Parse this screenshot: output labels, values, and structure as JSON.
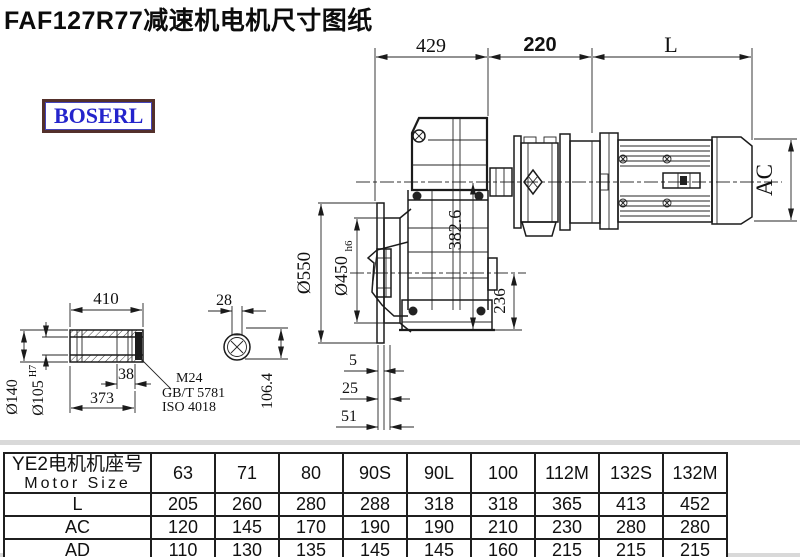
{
  "title": "FAF127R77减速机电机尺寸图纸",
  "logo_text": "BOSERL",
  "drawing": {
    "top_dims": {
      "a": "429",
      "b": "220",
      "c": "L"
    },
    "dims": {
      "ac": "AC",
      "v3826": "382.6",
      "v236": "236",
      "d550": "Ø550",
      "d450": "Ø450",
      "d450_suffix": "h6",
      "s5": "5",
      "s25": "25",
      "s51": "51",
      "shaft_len": "410",
      "shaft_38": "38",
      "shaft_373": "373",
      "d140": "Ø140",
      "d105": "Ø105",
      "d105_sup": "H7",
      "key_w": "28",
      "key_h": "106.4"
    },
    "bolt_note": {
      "line1": "M24",
      "line2": "GB/T 5781",
      "line3": "ISO 4018"
    }
  },
  "table": {
    "header_line1": "YE2电机机座号",
    "header_line2": "Motor Size",
    "columns": [
      "63",
      "71",
      "80",
      "90S",
      "90L",
      "100",
      "112M",
      "132S",
      "132M"
    ],
    "rows": [
      {
        "label": "L",
        "values": [
          "205",
          "260",
          "280",
          "288",
          "318",
          "318",
          "365",
          "413",
          "452"
        ]
      },
      {
        "label": "AC",
        "values": [
          "120",
          "145",
          "170",
          "190",
          "190",
          "210",
          "230",
          "280",
          "280"
        ]
      },
      {
        "label": "AD",
        "values": [
          "110",
          "130",
          "135",
          "145",
          "145",
          "160",
          "215",
          "215",
          "215"
        ]
      }
    ]
  }
}
